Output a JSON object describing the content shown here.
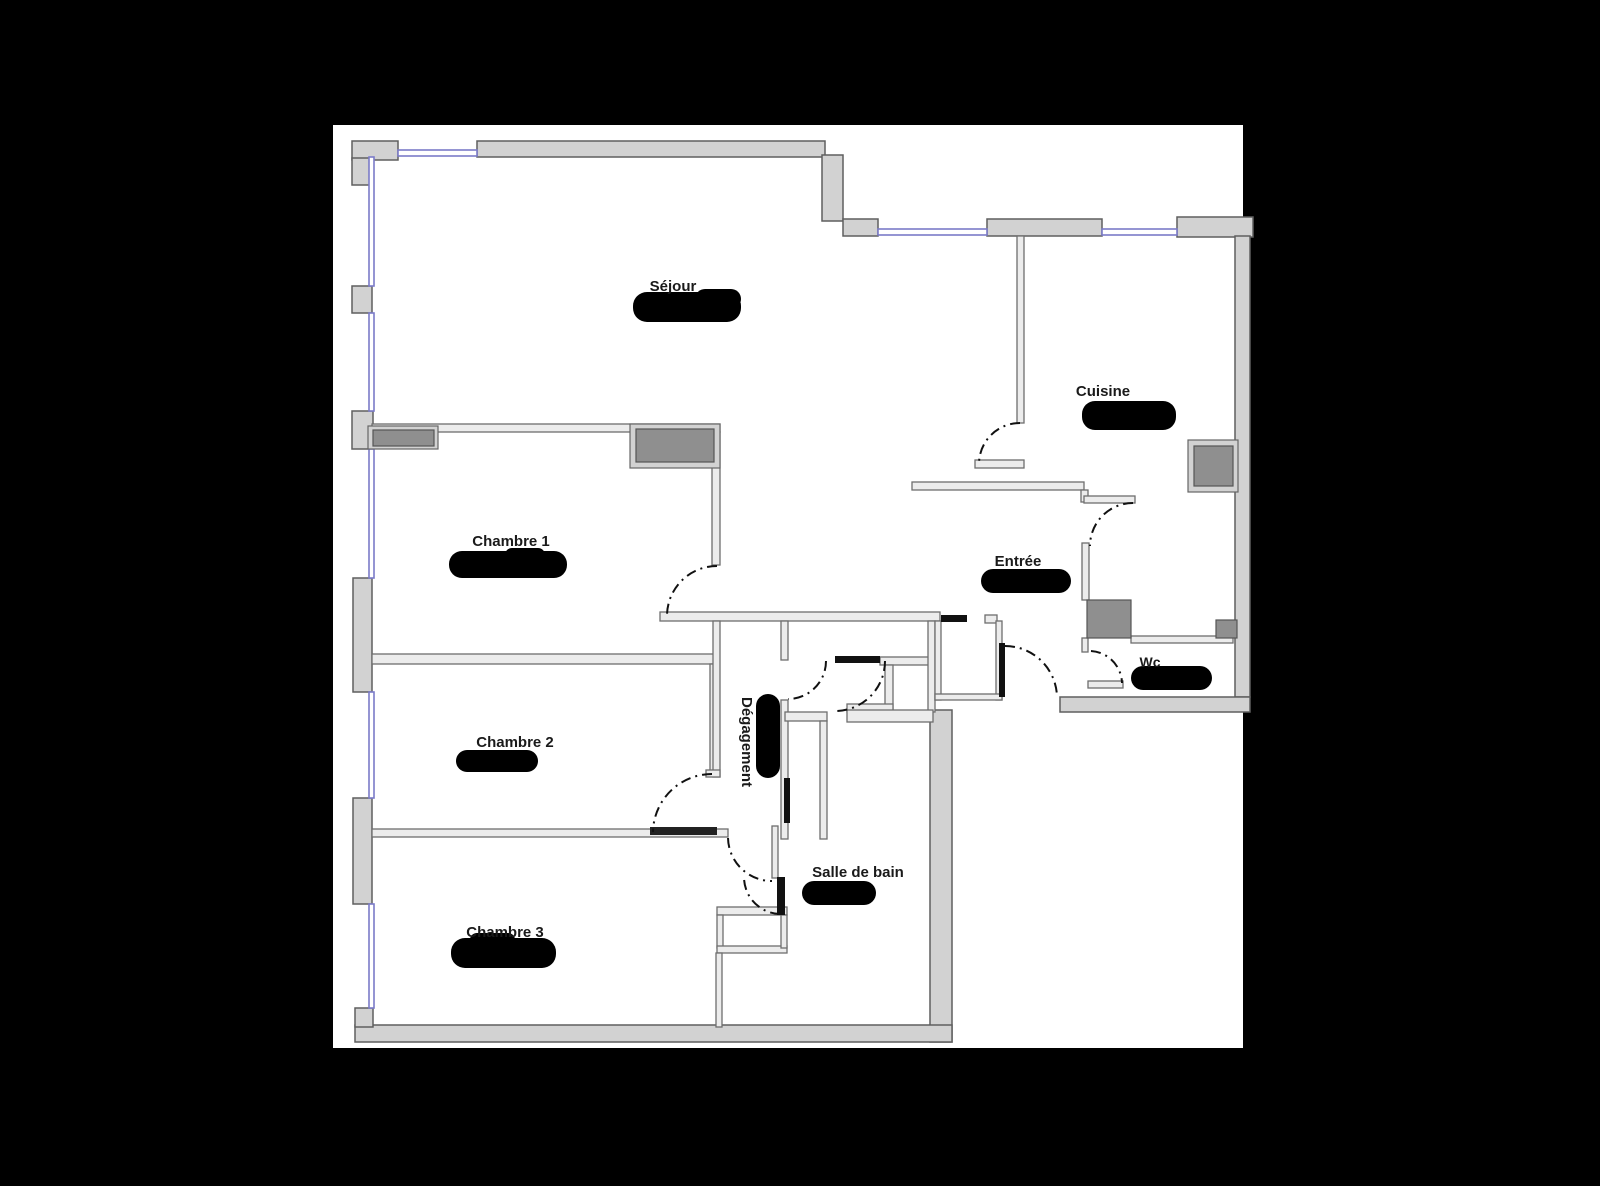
{
  "plan": {
    "type": "apartment-floor-plan",
    "palette": {
      "background": "#000000",
      "canvas": "#ffffff",
      "outer_wall_fill": "#d2d2d2",
      "outer_wall_outline": "#5f5f5f",
      "interior_wall_fill": "#ececec",
      "interior_wall_outline": "#6e6e6e",
      "fixture_fill": "#8f8f8f",
      "fixture_outline": "#555555",
      "window_color": "#7b7bc8",
      "door_arc_color": "#111111",
      "door_leaf_color": "#111111",
      "redaction_color": "#000000",
      "label_color": "#1a1a1a"
    },
    "rooms": [
      {
        "id": "sejour",
        "name": "Séjour",
        "area_redacted": true
      },
      {
        "id": "cuisine",
        "name": "Cuisine",
        "area_redacted": true
      },
      {
        "id": "chambre1",
        "name": "Chambre 1",
        "area_redacted": true
      },
      {
        "id": "entree",
        "name": "Entrée",
        "area_redacted": true
      },
      {
        "id": "wc",
        "name": "Wc",
        "area_redacted": true
      },
      {
        "id": "chambre2",
        "name": "Chambre 2",
        "area_redacted": true
      },
      {
        "id": "degagement",
        "name": "Dégagement",
        "area_redacted": true
      },
      {
        "id": "salle_de_bain",
        "name": "Salle de bain",
        "area_redacted": true
      },
      {
        "id": "chambre3",
        "name": "Chambre 3",
        "area_redacted": true
      }
    ]
  }
}
